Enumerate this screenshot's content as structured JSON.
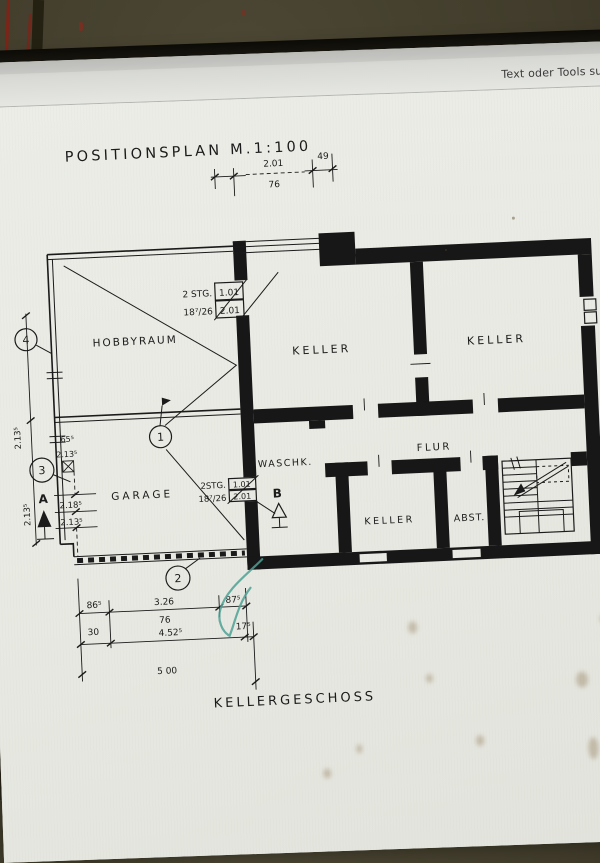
{
  "toolbar": {
    "search_label": "Text oder Tools suche"
  },
  "plan": {
    "title": "POSITIONSPLAN  M.1:100",
    "floor_label": "KELLERGESCHOSS",
    "rooms": {
      "hobbyraum": "HOBBYRAUM",
      "garage": "GARAGE",
      "keller_mid": "KELLER",
      "keller_right": "KELLER",
      "waschkueche": "WASCHK.",
      "flur": "FLUR",
      "keller_small": "KELLER",
      "abstellraum": "ABST."
    },
    "stair_top": {
      "line1": "2 STG.",
      "line2": "18⁷/26",
      "box_upper": "1.01",
      "box_lower": "2.01"
    },
    "stair_mid": {
      "line1": "2STG.",
      "line2": "18⁷/26",
      "box_upper": "1.01",
      "box_lower": "2.01"
    },
    "markers": {
      "pos1": "1",
      "pos2": "2",
      "pos3": "3",
      "pos4": "4",
      "section_a": "A",
      "section_b": "B"
    },
    "dims_top": {
      "left": "49",
      "middle": "2.01",
      "right": "49",
      "below": "76"
    },
    "dims_bottom": {
      "d1": "86⁵",
      "d2": "3.26",
      "d3": "87⁵",
      "d4": "30",
      "d5": "76",
      "d6": "4.52⁵",
      "d7": "17⁵",
      "d8": "5 00"
    },
    "dims_left": {
      "v_upper": "2.13⁵",
      "v_lower": "2.13⁵",
      "g1": "65⁵",
      "g2": "2.13⁵",
      "g3": "2.18⁵",
      "g4": "2.13⁵"
    }
  },
  "colors": {
    "accent_teal": "#4ea195",
    "paper": "#e9eae3",
    "ink": "#1b1b1b"
  }
}
